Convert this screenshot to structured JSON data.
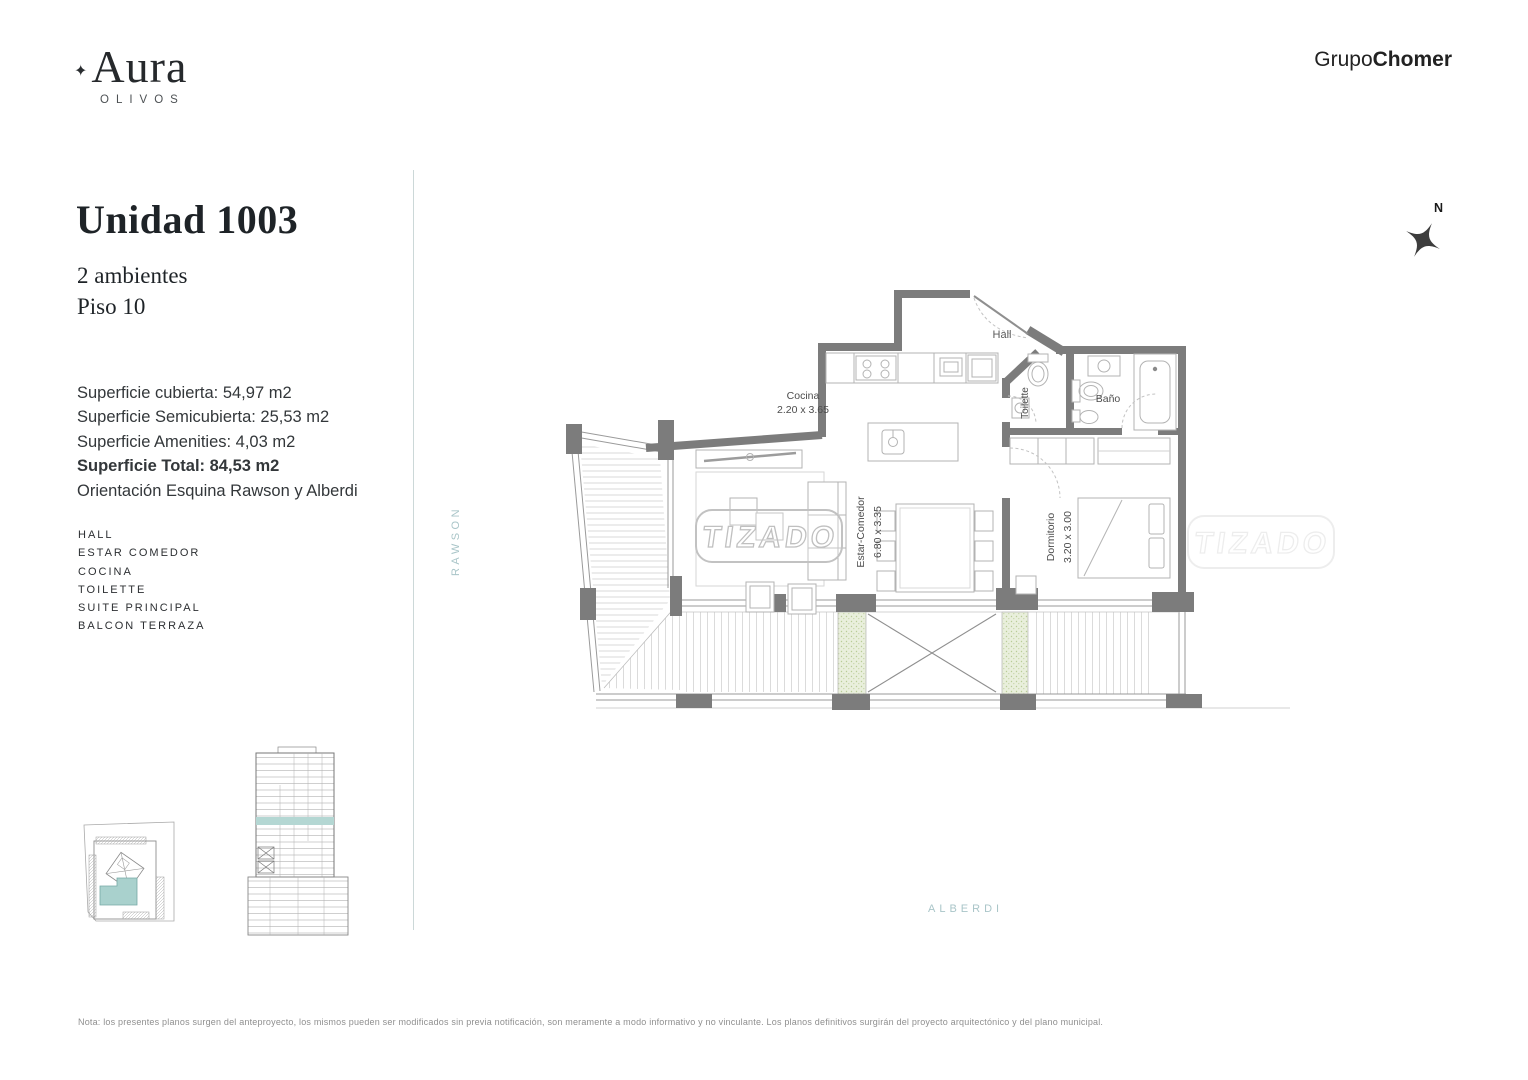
{
  "brand": {
    "mark": "✦",
    "name": "Aura",
    "location": "OLIVOS"
  },
  "developer": {
    "prefix": "Grupo",
    "suffix": "Chomer"
  },
  "unit": {
    "title": "Unidad 1003",
    "lines": [
      "2 ambientes",
      "Piso 10"
    ]
  },
  "surfaces": {
    "cubierta": "Superficie cubierta: 54,97 m2",
    "semicubierta": "Superficie Semicubierta: 25,53 m2",
    "amenities": "Superficie Amenities: 4,03 m2",
    "total": "Superficie Total: 84,53 m2",
    "orientacion": "Orientación Esquina Rawson y Alberdi"
  },
  "rooms": [
    "HALL",
    "ESTAR COMEDOR",
    "COCINA",
    "TOILETTE",
    "SUITE PRINCIPAL",
    "BALCON TERRAZA"
  ],
  "plan": {
    "watermark": "TIZADO",
    "compass": "N",
    "streets": {
      "west": "RAWSON",
      "south": "ALBERDI"
    },
    "labels": {
      "hall": "Hall",
      "cocina": "Cocina",
      "cocina_dim": "2.20 x 3.65",
      "toilette": "Toilette",
      "bano": "Baño",
      "estar": "Estar-Comedor",
      "estar_dim": "6.80 x 3.35",
      "dormitorio": "Dormitorio",
      "dormitorio_dim": "3.20 x 3.00"
    }
  },
  "note": "Nota: los presentes planos surgen del anteproyecto, los mismos pueden ser modificados sin previa notificación, son meramente a modo informativo y no vinculante. Los planos definitivos surgirán del proyecto arquitectónico y del plano municipal.",
  "colors": {
    "wall": "#7c7c7c",
    "street_label": "#a9c5c8",
    "unit_highlight": "#a9d1cd",
    "floor_highlight": "#b4d7d3",
    "hatch_green": "#e9efdc"
  }
}
